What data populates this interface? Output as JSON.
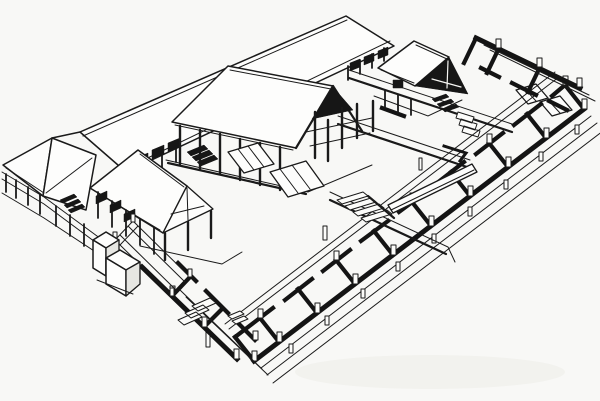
{
  "canvas": {
    "width": 600,
    "height": 401
  },
  "colors": {
    "paper": "#f8f8f6",
    "ink": "#1a1a1a",
    "wall_black": "#141414",
    "roof_white": "#fdfdfc",
    "shade": "#e6e6e2",
    "smudge": "#f2f2ee"
  },
  "figure": {
    "kind": "architectural-axonometric-line-drawing",
    "style": "black ink on white, half reconstruction with roofs / half excavated black foundation walls",
    "parts": [
      "rear-hall-roof",
      "corner-pavilion",
      "west-side-hall",
      "gate-hall",
      "northeast-hall",
      "front-courtyard",
      "rear-courtyard",
      "east-wing-ruins",
      "northeast-wing-ruins",
      "southwest-wing-ruins",
      "walled-room",
      "screen-wall-block",
      "platform-apron",
      "ramps",
      "stairs",
      "drain-pipe",
      "post-stubs"
    ]
  }
}
